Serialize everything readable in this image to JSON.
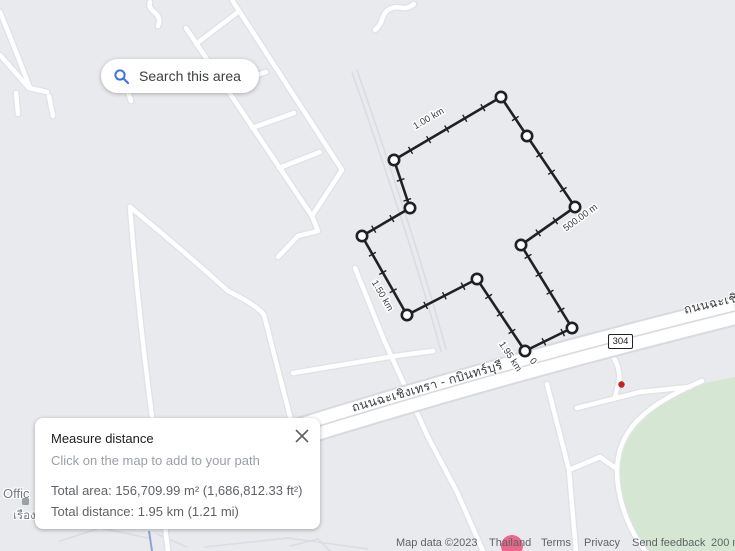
{
  "colors": {
    "map_background": "#e8eaed",
    "measure_path": "#202124",
    "vertex_fill": "#ffffff",
    "search_icon_blue": "#4175df",
    "green_area": "#d5e7d2",
    "poi_red_dot": "#c5221f",
    "poi_pink": "#e9688b"
  },
  "search_button": {
    "label": "Search this area"
  },
  "measure_panel": {
    "title": "Measure distance",
    "subtitle": "Click on the map to add to your path",
    "total_area": "Total area: 156,709.99 m² (1,686,812.33 ft²)",
    "total_distance": "Total distance: 1.95 km (1.21 mi)"
  },
  "map_labels": {
    "route_badge": "304",
    "road_main": "ถนนฉะเชิงเทรา - กบินทร์บุรี",
    "road_ne": "ถนนฉะเชิงเทรา - กบินทร์บุรี",
    "poi_office": "Offic",
    "poi_thai": "เรือง"
  },
  "measurement": {
    "closed": true,
    "vertices": [
      [
        525,
        351
      ],
      [
        572,
        328
      ],
      [
        521,
        245
      ],
      [
        575,
        207
      ],
      [
        527,
        136
      ],
      [
        501,
        97
      ],
      [
        394,
        160
      ],
      [
        410,
        208
      ],
      [
        362,
        236
      ],
      [
        407,
        315
      ],
      [
        477,
        279
      ]
    ],
    "labels": [
      {
        "text": "0",
        "x": 531,
        "y": 363,
        "rotate": 50
      },
      {
        "text": "1.95 km",
        "x": 508,
        "y": 358,
        "rotate": 57
      },
      {
        "text": "500.00 m",
        "x": 582,
        "y": 220,
        "rotate": -36
      },
      {
        "text": "1.00 km",
        "x": 430,
        "y": 121,
        "rotate": -30
      },
      {
        "text": "1.50 km",
        "x": 380,
        "y": 297,
        "rotate": 60
      }
    ]
  },
  "attribution": {
    "map_data": "Map data ©2023",
    "region": "Thailand",
    "terms": "Terms",
    "privacy": "Privacy",
    "feedback": "Send feedback",
    "scale": "200 m"
  }
}
